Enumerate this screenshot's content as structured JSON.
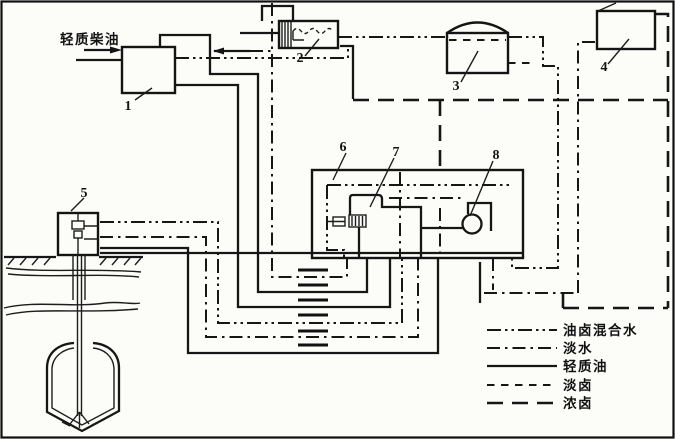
{
  "figure": {
    "feed_label": "轻质柴油",
    "components": [
      {
        "id": "1",
        "label": "1"
      },
      {
        "id": "2",
        "label": "2"
      },
      {
        "id": "3",
        "label": "3"
      },
      {
        "id": "4",
        "label": "4"
      },
      {
        "id": "5",
        "label": "5"
      },
      {
        "id": "6",
        "label": "6"
      },
      {
        "id": "7",
        "label": "7"
      },
      {
        "id": "8",
        "label": "8"
      }
    ],
    "legend": {
      "items": [
        {
          "label": "油卤混合水",
          "style": "dash-dot-dot"
        },
        {
          "label": "淡水",
          "style": "dash-dot"
        },
        {
          "label": "轻质油",
          "style": "solid"
        },
        {
          "label": "淡卤",
          "style": "short-dash"
        },
        {
          "label": "浓卤",
          "style": "long-dash"
        }
      ]
    },
    "colors": {
      "ink": "#161616",
      "paper": "#fcfcf9"
    }
  }
}
